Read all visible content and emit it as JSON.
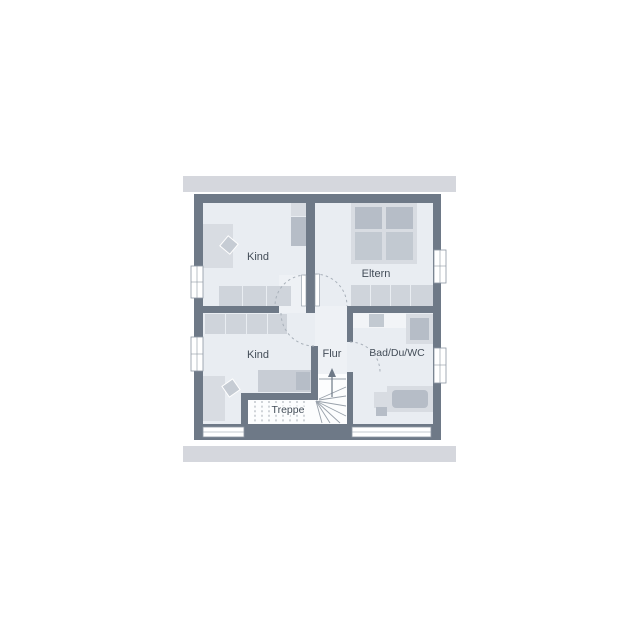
{
  "plan": {
    "title": "upper floor plan",
    "rooms": [
      {
        "id": "kind-1",
        "label": "Kind"
      },
      {
        "id": "eltern",
        "label": "Eltern"
      },
      {
        "id": "kind-2",
        "label": "Kind"
      },
      {
        "id": "flur",
        "label": "Flur"
      },
      {
        "id": "bad",
        "label": "Bad/Du/WC"
      },
      {
        "id": "treppe",
        "label": "Treppe"
      }
    ],
    "colors": {
      "wall": "#6e7987",
      "floor": "#e9edf2",
      "roof_bar": "#d5d7dd",
      "stairs_background": "#fcfdfe",
      "furniture_light": "#d8dce2",
      "furniture_dark": "#b6bdc7",
      "label_text": "#434d58",
      "door_arc": "#a9b1ba",
      "background": "#ffffff"
    }
  }
}
